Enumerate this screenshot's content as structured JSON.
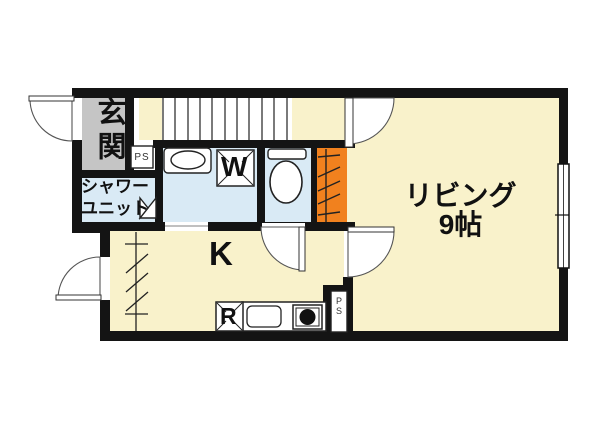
{
  "plan": {
    "labels": {
      "entrance": "玄関",
      "shower_line1": "シャワー",
      "shower_line2": "ユニット",
      "pipe_space_top": "PS",
      "washing_machine": "W",
      "kitchen": "K",
      "living_line1": "リビング",
      "living_line2": "9帖",
      "refrigerator": "R",
      "pipe_space_bottom": "PS"
    },
    "colors": {
      "floor_cream": "#f9f2cb",
      "wet_area_blue": "#d9eaf5",
      "entrance_gray": "#c5c5c5",
      "hatch_orange": "#f1811e",
      "wall_black": "#141414",
      "background": "#ffffff"
    }
  }
}
